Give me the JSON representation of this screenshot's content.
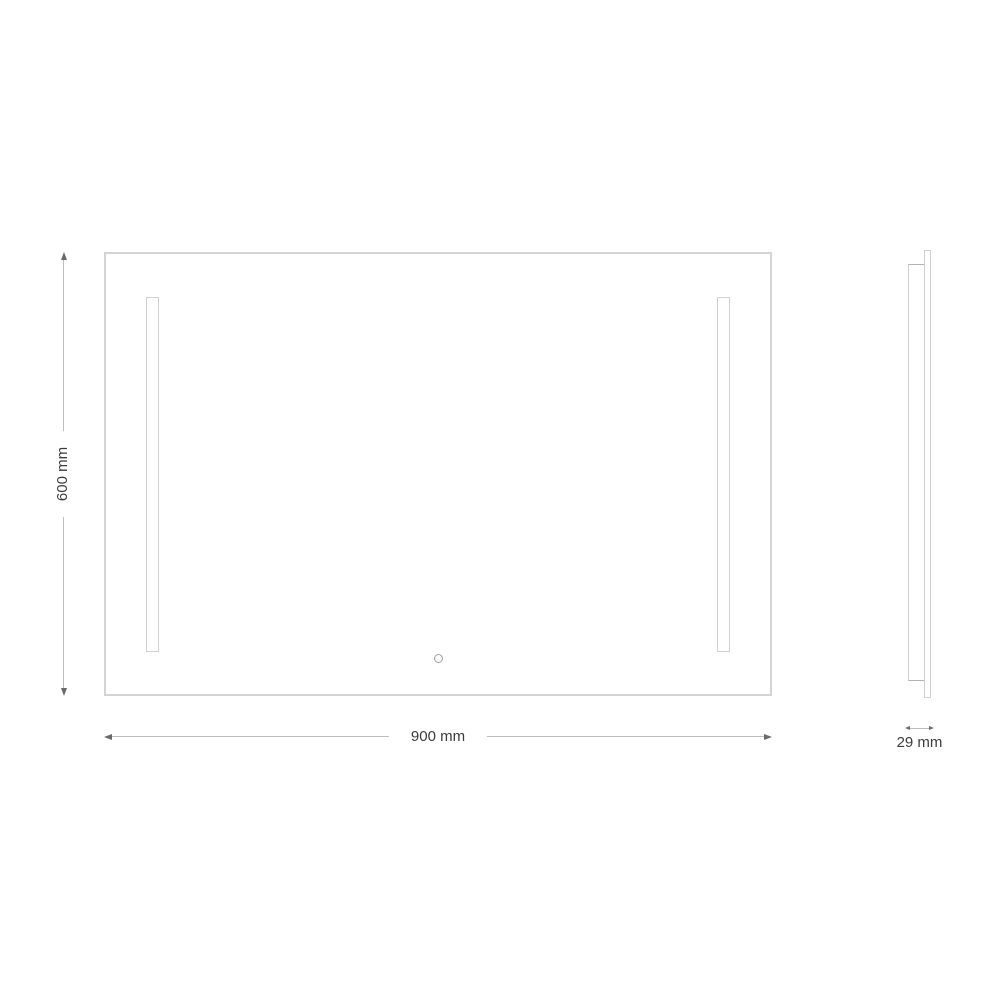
{
  "drawing": {
    "type": "mirror-dimension-diagram",
    "front_view": {
      "width_label": "900 mm",
      "height_label": "600 mm",
      "width_value": 900,
      "height_value": 600,
      "unit": "mm"
    },
    "side_view": {
      "depth_label": "29 mm",
      "depth_value": 29,
      "unit": "mm"
    },
    "colors": {
      "background": "#ffffff",
      "outline": "#d4d4d4",
      "outline_dark": "#b3b3b3",
      "dimension_line": "#bdbdbd",
      "arrow": "#6a6a6a",
      "text": "#3c3c3c"
    }
  }
}
